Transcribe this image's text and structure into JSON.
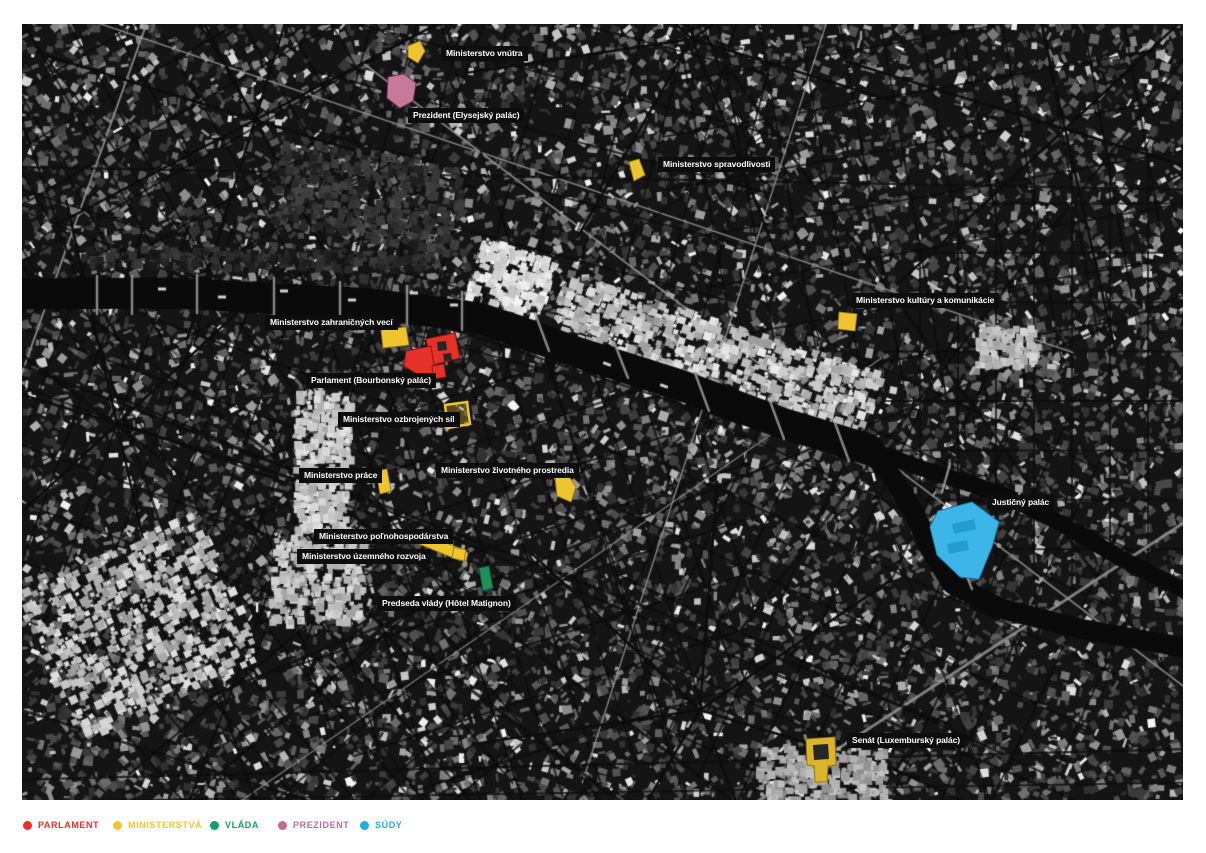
{
  "legend": {
    "items": [
      {
        "key": "parlament",
        "label": "PARLAMENT",
        "color": "#e73128"
      },
      {
        "key": "ministerstva",
        "label": "MINISTERSTVÁ",
        "color": "#f5c52c"
      },
      {
        "key": "vlada",
        "label": "VLÁDA",
        "color": "#0ea365"
      },
      {
        "key": "prezident",
        "label": "PREZIDENT",
        "color": "#bf6c92"
      },
      {
        "key": "sudy",
        "label": "SÚDY",
        "color": "#1caee9"
      }
    ]
  },
  "map": {
    "style": {
      "label_background": "#0d0d0d",
      "label_text_color": "#ffffff",
      "water_color": "#0a0a0a"
    },
    "labels": [
      {
        "id": "vnutra",
        "text": "Ministerstvo vnútra"
      },
      {
        "id": "prezident",
        "text": "Prezident (Elysejský palác)"
      },
      {
        "id": "spravodlivost",
        "text": "Ministerstvo spravodlivosti"
      },
      {
        "id": "kultura",
        "text": "Ministerstvo kultúry a komunikácie"
      },
      {
        "id": "zahranicne-veci",
        "text": "Ministerstvo zahraničných vecí"
      },
      {
        "id": "parlament",
        "text": "Parlament (Bourbonský palác)"
      },
      {
        "id": "ozbrojene-sily",
        "text": "Ministerstvo ozbrojených síl"
      },
      {
        "id": "praca",
        "text": "Ministerstvo práce"
      },
      {
        "id": "zivotne-prostredie",
        "text": "Ministerstvo životného prostredia"
      },
      {
        "id": "polnohospodarstvo",
        "text": "Ministerstvo poľnohospodárstva"
      },
      {
        "id": "uzemny-rozvoj",
        "text": "Ministerstvo územného rozvoja"
      },
      {
        "id": "predseda-vlady",
        "text": "Predseda vlády (Hôtel Matignon)"
      },
      {
        "id": "justicny-palac",
        "text": "Justičný palác"
      },
      {
        "id": "senat",
        "text": "Senát (Luxemburský palác)"
      }
    ],
    "buildings": [
      {
        "id": "vnutra",
        "category": "ministerstva",
        "fill": "#eec52e",
        "stroke": "#9c7d12"
      },
      {
        "id": "prezident",
        "category": "prezident",
        "fill": "#c47a9b",
        "stroke": "#8e3055"
      },
      {
        "id": "spravodlivost",
        "category": "ministerstva",
        "fill": "#eec52e",
        "stroke": "#9c7d12"
      },
      {
        "id": "kultura",
        "category": "ministerstva",
        "fill": "#eec52e",
        "stroke": "#9c7d12"
      },
      {
        "id": "zahranicne-veci",
        "category": "ministerstva",
        "fill": "#eec52e",
        "stroke": "#9c7d12"
      },
      {
        "id": "parlament",
        "category": "parlament",
        "fill": "#e5312a",
        "stroke": "#8f150d"
      },
      {
        "id": "ozbrojene-sily",
        "category": "ministerstva",
        "fill": "rgba(238,197,46,0.30)",
        "stroke": "#eec52e"
      },
      {
        "id": "praca",
        "category": "ministerstva",
        "fill": "#eec52e",
        "stroke": "#9c7d12"
      },
      {
        "id": "zivotne-prostredie",
        "category": "ministerstva",
        "fill": "#eec52e",
        "stroke": "#9c7d12"
      },
      {
        "id": "polnohospodarstvo",
        "category": "ministerstva",
        "fill": "#eec52e",
        "stroke": "#9c7d12"
      },
      {
        "id": "predseda-vlady",
        "category": "vlada",
        "fill": "#1d8f58",
        "stroke": "#0c5c36"
      },
      {
        "id": "justicny-palac",
        "category": "sudy",
        "fill": "#3cb6e9",
        "stroke": "#1580b0"
      },
      {
        "id": "senat",
        "category": "ministerstva",
        "fill": "#ddb32c",
        "stroke": "#93750f"
      }
    ]
  }
}
